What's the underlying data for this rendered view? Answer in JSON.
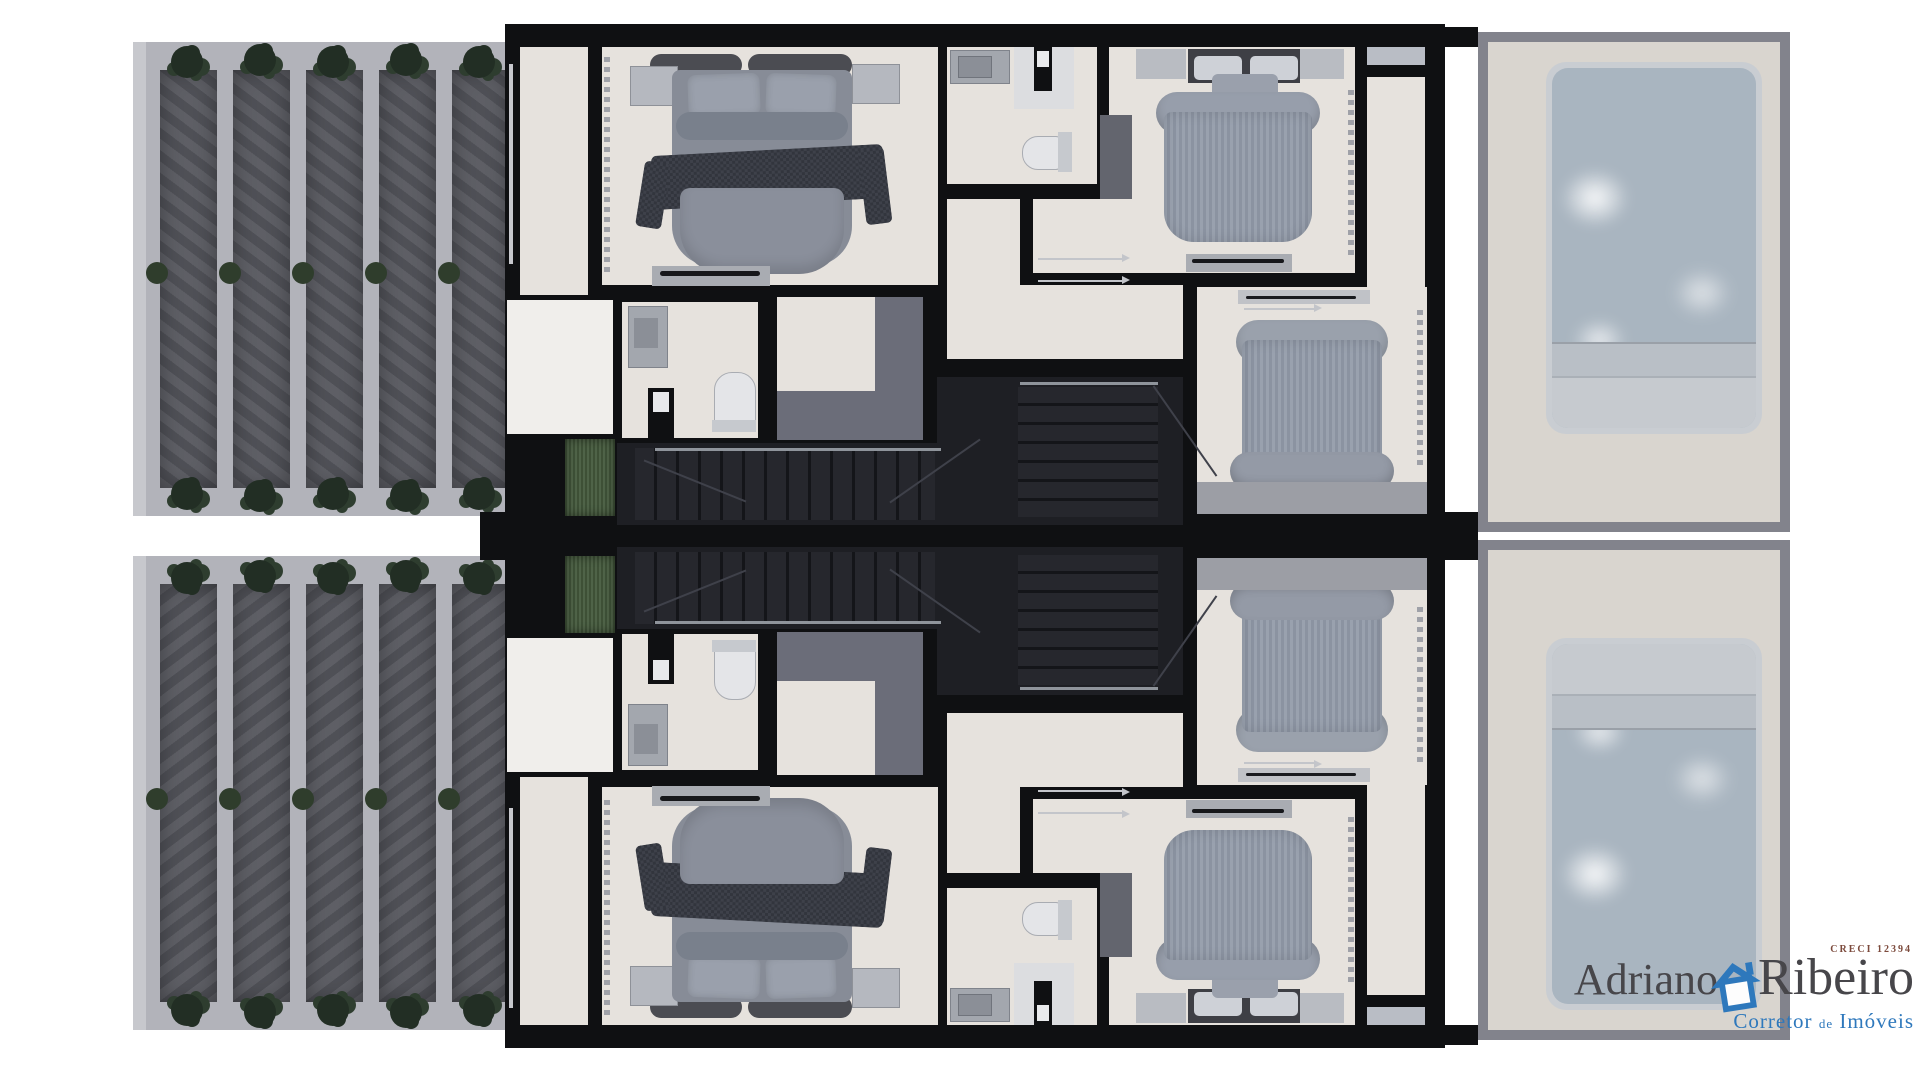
{
  "canvas": {
    "width": 1920,
    "height": 1080,
    "background": "#ffffff"
  },
  "palette": {
    "wall": "#0f1012",
    "floor": "#e6e2dd",
    "floor_light": "#f0eeeb",
    "gravel": "#b2b3ba",
    "gravel_edge": "#c7c8cd",
    "panel": "#55565d",
    "tree": "#222e24",
    "tree2": "#2e3d2f",
    "bush": "#2f3d2c",
    "grass": "#465b3e",
    "gray_mid": "#6b6d79",
    "stair": "#1e1f24",
    "tread_a": "#26272d",
    "tread_b": "#141519",
    "rail": "#8f949b",
    "deck": "#d9d5cf",
    "deck_border": "#82838c",
    "pool_rim": "#c9cdd2",
    "water": "#a9b5c0",
    "bench": "#b9bfc6",
    "ledge": "#c6cacf",
    "furn": "#a9acb2",
    "cab": "#63656e",
    "bed": "#878c97",
    "pillow": "#9aa0ac",
    "pillow_light": "#ced1d7",
    "fold": "#79808c",
    "throw": "#32353d",
    "throw2": "#3e414a",
    "stripe_a": "#99a1ae",
    "stripe_b": "#8b93a1",
    "fixture": "#e4e5e8",
    "fixture_dark": "#c6c9ce",
    "vanity": "#a3a7ae",
    "basin": "#8b8f97",
    "win": "#9fa1a8",
    "band": "#9c9ea5",
    "logo_name": "#47464a",
    "logo_creci": "#7c4a3c",
    "logo_blue": "#2e78bc"
  },
  "logo": {
    "first_name": "Adriano",
    "last_name": "Ribeiro",
    "creci": "CRECI 12394",
    "tagline": [
      "Corretor",
      "de",
      "Imóveis"
    ],
    "icon": "house-icon"
  },
  "plan": {
    "unit_count": 2,
    "mirrored_layout": true,
    "rooms": [
      "garden-driveway",
      "balcony",
      "master-bedroom",
      "bathroom",
      "hallway",
      "vestibule",
      "closet",
      "powder-room",
      "bedroom-2",
      "bedroom-3",
      "stairs",
      "entry-porch",
      "planter",
      "pool-deck",
      "swimming-pool"
    ],
    "furniture": [
      "double-bed",
      "single-bed",
      "nightstand",
      "wardrobe",
      "dresser",
      "tv-console",
      "desk",
      "toilet",
      "washbasin",
      "shower"
    ],
    "garden": {
      "panel_count": 5,
      "trees_top_row": 5,
      "trees_bottom_row": 5,
      "bush_count": 5
    },
    "pools": {
      "count": 2
    }
  }
}
